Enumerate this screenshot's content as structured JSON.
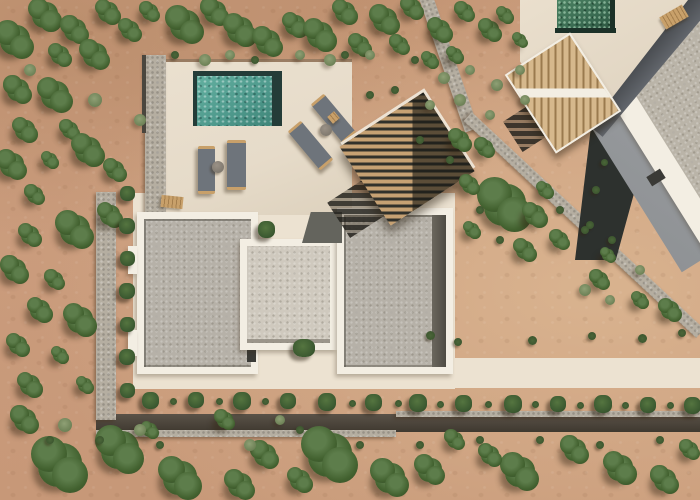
{
  "scene": {
    "description": "Aerial drone photograph of a modern villa: cream pool terrace with teal plunge pool and four grey sun loungers, three gravel flat roofs framed in white, wooden slatted pergola, stone perimeter walls, rows of landscaped plants, sandy garden with scattered green trees, and a neighboring villa with green plunge pool at upper right.",
    "colors": {
      "sand-base": "#cd9f80",
      "sand-dark": "#bb8e6d",
      "sand-light": "#d9b38f",
      "terrace": "#e6dbc9",
      "walkway": "#ece2d1",
      "white-trim": "#f3eee3",
      "gravel-warm": "#b6b1a8",
      "gravel-light": "#cfc9be",
      "gravel-neighbor": "#bab4a8",
      "dark-paving": "#64645d",
      "pool-teal": "#4f9a8d",
      "pool-rim": "#243c38",
      "neighbor-pool-green": "#3a6b52",
      "stone": "#b5aea1",
      "wall-shadow": "#3f3930",
      "tree-green": "#42612f",
      "shrub-sage": "#6d8156",
      "cushion-gray": "#6e747b",
      "wood-tan": "#c8a06a",
      "pergola-wood": "#c6a173",
      "pergola-gap": "#31312b",
      "neighbor-wall-gray": "#9b9ea1",
      "shadow-gap": "#2d312e"
    },
    "objects": [
      {
        "name": "boundary-wall-upper",
        "cls": "stone-wall",
        "x": 442,
        "y": -6,
        "w": 14,
        "h": 140,
        "rot": -19
      },
      {
        "name": "boundary-wall-lower",
        "cls": "stone-wall",
        "x": 425,
        "y": 219,
        "w": 318,
        "h": 12,
        "rot": 43
      },
      {
        "name": "perimeter-wall-bottom-dark",
        "cls": "wall-dark-band",
        "x": 96,
        "y": 414,
        "w": 604,
        "h": 18
      },
      {
        "name": "perimeter-wall-bottom-light",
        "cls": "stone-wall",
        "x": 96,
        "y": 430,
        "w": 300,
        "h": 7
      },
      {
        "name": "perimeter-wall-bottom-light-right",
        "cls": "stone-wall",
        "x": 396,
        "y": 411,
        "w": 304,
        "h": 6
      },
      {
        "name": "perimeter-wall-left",
        "cls": "stone-wall",
        "x": 96,
        "y": 192,
        "w": 20,
        "h": 228
      },
      {
        "name": "neighbor-shadow-gap",
        "cls": "gap-dark",
        "x": 558,
        "y": 118,
        "w": 85,
        "h": 142
      },
      {
        "name": "neighbor-wall-face",
        "cls": "nwall",
        "x": 594,
        "y": -34,
        "w": 214,
        "h": 270,
        "rot": -32
      },
      {
        "name": "neighbor-roof-border",
        "cls": "white-rect",
        "x": 622,
        "y": -36,
        "w": 184,
        "h": 256,
        "rot": -32
      },
      {
        "name": "neighbor-roof-gravel",
        "cls": "gravel-n",
        "x": 644,
        "y": -34,
        "w": 160,
        "h": 240,
        "rot": -32
      },
      {
        "name": "neighbor-roof-vent",
        "cls": "vent",
        "x": 648,
        "y": 172,
        "w": 16,
        "h": 11,
        "rot": -32
      },
      {
        "name": "neighbor-shadow-wall",
        "cls": "ndark",
        "x": 563,
        "y": 52,
        "w": 170,
        "h": 24,
        "rot": 130
      },
      {
        "name": "neighbor-pool-deck",
        "cls": "ndeck",
        "x": 520,
        "y": 0,
        "w": 168,
        "h": 118
      },
      {
        "name": "neighbor-pool",
        "cls": "npool",
        "x": 557,
        "y": 0,
        "w": 55,
        "h": 30
      },
      {
        "name": "neighbor-pool-rim-bottom",
        "cls": "npool-rim",
        "x": 555,
        "y": 28,
        "w": 61,
        "h": 5
      },
      {
        "name": "neighbor-pool-rim-right",
        "cls": "npool-rim",
        "x": 610,
        "y": 0,
        "w": 5,
        "h": 32
      },
      {
        "name": "neighbor-deck-bench",
        "cls": "wood-bench",
        "x": 661,
        "y": 10,
        "w": 26,
        "h": 14,
        "rot": -30
      },
      {
        "name": "villa-walkway",
        "cls": "walkway",
        "x": 133,
        "y": 193,
        "w": 322,
        "h": 196
      },
      {
        "name": "garden-path",
        "cls": "walkway",
        "x": 345,
        "y": 358,
        "w": 355,
        "h": 30
      },
      {
        "name": "pool-terrace",
        "cls": "patio",
        "x": 165,
        "y": 62,
        "w": 187,
        "h": 153
      },
      {
        "name": "terrace-top-edge",
        "cls": "edge-line",
        "x": 166,
        "y": 59,
        "w": 186,
        "h": 3
      },
      {
        "name": "perimeter-wall-terrace",
        "cls": "stone-wall",
        "x": 145,
        "y": 55,
        "w": 21,
        "h": 160
      },
      {
        "name": "terrace-wall-shadow",
        "cls": "dark-line",
        "x": 142,
        "y": 55,
        "w": 4,
        "h": 78
      },
      {
        "name": "roof-left-frame",
        "cls": "white-rect",
        "x": 137,
        "y": 212,
        "w": 121,
        "h": 162
      },
      {
        "name": "roof-left-gravel",
        "cls": "gravel-a",
        "x": 144,
        "y": 219,
        "w": 107,
        "h": 148
      },
      {
        "name": "roof-left-door",
        "cls": "vent",
        "x": 247,
        "y": 338,
        "w": 9,
        "h": 24
      },
      {
        "name": "roof-left-tab-upper",
        "cls": "white-rect",
        "x": 128,
        "y": 246,
        "w": 9,
        "h": 28
      },
      {
        "name": "roof-left-tab-lower",
        "cls": "white-rect",
        "x": 128,
        "y": 330,
        "w": 9,
        "h": 26
      },
      {
        "name": "roof-middle-frame",
        "cls": "white-rect",
        "x": 240,
        "y": 239,
        "w": 97,
        "h": 111
      },
      {
        "name": "roof-middle-gravel",
        "cls": "gravel-b",
        "x": 247,
        "y": 246,
        "w": 83,
        "h": 97
      },
      {
        "name": "roof-right-frame",
        "cls": "white-rect",
        "x": 337,
        "y": 208,
        "w": 116,
        "h": 166
      },
      {
        "name": "roof-right-gravel",
        "cls": "gravel-a",
        "x": 344,
        "y": 215,
        "w": 102,
        "h": 152
      },
      {
        "name": "roof-right-dark-strip",
        "cls": "dark-strip",
        "x": 432,
        "y": 215,
        "w": 14,
        "h": 152
      },
      {
        "name": "dark-paving-patch",
        "cls": "dark-pav",
        "x": 302,
        "y": 212,
        "w": 40,
        "h": 31
      },
      {
        "name": "plunge-pool",
        "cls": "pool",
        "x": 196,
        "y": 74,
        "w": 84,
        "h": 52
      },
      {
        "name": "pool-rim-top",
        "cls": "pool-rim",
        "x": 196,
        "y": 71,
        "w": 84,
        "h": 5
      },
      {
        "name": "pool-rim-right",
        "cls": "pool-rim",
        "x": 272,
        "y": 71,
        "w": 10,
        "h": 55
      },
      {
        "name": "pool-rim-left",
        "cls": "pool-rim",
        "x": 193,
        "y": 71,
        "w": 4,
        "h": 55
      },
      {
        "name": "sun-lounger-1",
        "cls": "lounger",
        "x": 198,
        "y": 146,
        "w": 17,
        "h": 42
      },
      {
        "name": "sun-lounger-2",
        "cls": "lounger",
        "x": 227,
        "y": 140,
        "w": 19,
        "h": 44
      },
      {
        "name": "side-table-1",
        "cls": "round-table",
        "x": 212,
        "y": 161,
        "w": 12,
        "h": 12
      },
      {
        "name": "sun-lounger-3",
        "cls": "lounger",
        "x": 325,
        "y": 93,
        "w": 17,
        "h": 45,
        "rot": -40
      },
      {
        "name": "sun-lounger-4",
        "cls": "lounger",
        "x": 302,
        "y": 120,
        "w": 17,
        "h": 45,
        "rot": -40
      },
      {
        "name": "side-table-2",
        "cls": "round-table",
        "x": 320,
        "y": 124,
        "w": 12,
        "h": 12
      },
      {
        "name": "wood-stool",
        "cls": "wood-bench",
        "x": 329,
        "y": 113,
        "w": 9,
        "h": 9,
        "rot": -40
      },
      {
        "name": "terrace-bench",
        "cls": "wood-bench",
        "x": 161,
        "y": 196,
        "w": 22,
        "h": 12,
        "rot": 6
      },
      {
        "name": "terrace-planter",
        "cls": "plant",
        "x": 258,
        "y": 221,
        "w": 17,
        "h": 17
      },
      {
        "name": "courtyard-plant",
        "cls": "plant",
        "x": 293,
        "y": 339,
        "w": 22,
        "h": 18
      },
      {
        "name": "pergola-shadow",
        "cls": "pshadow",
        "x": 330,
        "y": 170,
        "w": 108,
        "h": 42,
        "rot": -33
      },
      {
        "name": "main-pergola",
        "cls": "pergola",
        "x": 357,
        "y": 112,
        "w": 100,
        "h": 94,
        "rot": -33
      },
      {
        "name": "neighbor-pergola-shadow",
        "cls": "pshadow",
        "x": 506,
        "y": 96,
        "w": 84,
        "h": 36,
        "rot": -33
      },
      {
        "name": "neighbor-pergola",
        "cls": "npergola",
        "x": 524,
        "y": 46,
        "w": 74,
        "h": 90,
        "rot": -33
      }
    ],
    "vegetation": {
      "trees": [
        [
          15,
          40,
          30
        ],
        [
          45,
          15,
          26
        ],
        [
          75,
          30,
          22
        ],
        [
          108,
          12,
          20
        ],
        [
          60,
          55,
          18
        ],
        [
          95,
          55,
          24
        ],
        [
          130,
          30,
          18
        ],
        [
          150,
          12,
          16
        ],
        [
          185,
          25,
          30
        ],
        [
          215,
          12,
          22
        ],
        [
          240,
          30,
          26
        ],
        [
          268,
          42,
          24
        ],
        [
          295,
          25,
          20
        ],
        [
          320,
          35,
          26
        ],
        [
          345,
          12,
          20
        ],
        [
          360,
          45,
          18
        ],
        [
          385,
          20,
          24
        ],
        [
          400,
          45,
          16
        ],
        [
          412,
          8,
          18
        ],
        [
          440,
          30,
          20
        ],
        [
          465,
          12,
          16
        ],
        [
          490,
          30,
          18
        ],
        [
          455,
          55,
          14
        ],
        [
          430,
          60,
          14
        ],
        [
          505,
          15,
          14
        ],
        [
          520,
          40,
          12
        ],
        [
          18,
          90,
          22
        ],
        [
          55,
          95,
          28
        ],
        [
          25,
          130,
          20
        ],
        [
          70,
          130,
          16
        ],
        [
          12,
          165,
          24
        ],
        [
          50,
          160,
          14
        ],
        [
          88,
          150,
          26
        ],
        [
          115,
          170,
          18
        ],
        [
          35,
          195,
          16
        ],
        [
          75,
          230,
          30
        ],
        [
          30,
          235,
          18
        ],
        [
          110,
          215,
          20
        ],
        [
          15,
          270,
          22
        ],
        [
          55,
          280,
          16
        ],
        [
          40,
          310,
          20
        ],
        [
          80,
          320,
          26
        ],
        [
          18,
          345,
          18
        ],
        [
          60,
          355,
          14
        ],
        [
          30,
          385,
          20
        ],
        [
          85,
          385,
          14
        ],
        [
          460,
          140,
          18
        ],
        [
          485,
          148,
          16
        ],
        [
          505,
          205,
          42
        ],
        [
          470,
          185,
          16
        ],
        [
          535,
          215,
          20
        ],
        [
          472,
          230,
          14
        ],
        [
          525,
          250,
          18
        ],
        [
          560,
          240,
          16
        ],
        [
          545,
          190,
          14
        ],
        [
          600,
          280,
          16
        ],
        [
          640,
          300,
          14
        ],
        [
          670,
          310,
          18
        ],
        [
          608,
          255,
          12
        ],
        [
          25,
          420,
          22
        ],
        [
          60,
          465,
          44
        ],
        [
          120,
          450,
          38
        ],
        [
          180,
          478,
          34
        ],
        [
          225,
          420,
          16
        ],
        [
          265,
          455,
          22
        ],
        [
          330,
          455,
          44
        ],
        [
          390,
          478,
          30
        ],
        [
          430,
          470,
          24
        ],
        [
          455,
          440,
          16
        ],
        [
          520,
          472,
          30
        ],
        [
          575,
          450,
          22
        ],
        [
          620,
          468,
          26
        ],
        [
          665,
          480,
          22
        ],
        [
          690,
          450,
          16
        ],
        [
          300,
          480,
          20
        ],
        [
          150,
          430,
          14
        ],
        [
          240,
          485,
          24
        ],
        [
          490,
          455,
          18
        ]
      ],
      "shrubs": [
        [
          95,
          100,
          14
        ],
        [
          140,
          120,
          12
        ],
        [
          30,
          70,
          12
        ],
        [
          65,
          425,
          14
        ],
        [
          140,
          430,
          12
        ],
        [
          250,
          445,
          12
        ],
        [
          280,
          420,
          10
        ],
        [
          205,
          60,
          12
        ],
        [
          230,
          55,
          10
        ],
        [
          330,
          60,
          12
        ],
        [
          370,
          55,
          10
        ],
        [
          300,
          55,
          10
        ],
        [
          444,
          78,
          12
        ],
        [
          470,
          70,
          10
        ],
        [
          497,
          85,
          12
        ],
        [
          520,
          70,
          10
        ],
        [
          460,
          100,
          12
        ],
        [
          490,
          115,
          10
        ],
        [
          430,
          105,
          10
        ],
        [
          525,
          100,
          10
        ],
        [
          585,
          290,
          12
        ],
        [
          640,
          270,
          10
        ],
        [
          610,
          300,
          10
        ]
      ],
      "tufts": [
        [
          175,
          55,
          8
        ],
        [
          255,
          60,
          8
        ],
        [
          345,
          55,
          8
        ],
        [
          415,
          60,
          8
        ],
        [
          450,
          160,
          8
        ],
        [
          480,
          210,
          8
        ],
        [
          500,
          240,
          8
        ],
        [
          430,
          335,
          9
        ],
        [
          458,
          342,
          8
        ],
        [
          532,
          340,
          9
        ],
        [
          592,
          336,
          8
        ],
        [
          642,
          338,
          9
        ],
        [
          682,
          333,
          8
        ],
        [
          560,
          210,
          8
        ],
        [
          590,
          225,
          8
        ],
        [
          612,
          240,
          8
        ],
        [
          370,
          95,
          8
        ],
        [
          395,
          90,
          8
        ],
        [
          420,
          140,
          8
        ],
        [
          585,
          230,
          8
        ],
        [
          596,
          190,
          8
        ],
        [
          604,
          162,
          7
        ],
        [
          50,
          440,
          8
        ],
        [
          100,
          440,
          8
        ],
        [
          160,
          445,
          8
        ],
        [
          300,
          430,
          8
        ],
        [
          360,
          445,
          8
        ],
        [
          420,
          445,
          8
        ],
        [
          480,
          440,
          8
        ],
        [
          540,
          440,
          8
        ],
        [
          600,
          445,
          8
        ],
        [
          660,
          440,
          8
        ],
        [
          173,
          401,
          7
        ],
        [
          219,
          401,
          7
        ],
        [
          265,
          401,
          7
        ],
        [
          352,
          403,
          7
        ],
        [
          398,
          403,
          7
        ],
        [
          440,
          404,
          7
        ],
        [
          488,
          404,
          7
        ],
        [
          535,
          404,
          7
        ],
        [
          580,
          405,
          7
        ],
        [
          625,
          405,
          7
        ],
        [
          670,
          405,
          7
        ]
      ],
      "row_plants": [
        [
          127,
          193,
          15
        ],
        [
          127,
          226,
          16
        ],
        [
          127,
          258,
          15
        ],
        [
          127,
          291,
          16
        ],
        [
          127,
          324,
          15
        ],
        [
          127,
          357,
          16
        ],
        [
          127,
          390,
          15
        ],
        [
          150,
          400,
          17
        ],
        [
          196,
          400,
          16
        ],
        [
          242,
          401,
          18
        ],
        [
          288,
          401,
          16
        ],
        [
          327,
          402,
          18
        ],
        [
          373,
          402,
          17
        ],
        [
          418,
          403,
          18
        ],
        [
          463,
          403,
          17
        ],
        [
          513,
          404,
          18
        ],
        [
          558,
          404,
          16
        ],
        [
          603,
          404,
          18
        ],
        [
          648,
          405,
          16
        ],
        [
          692,
          405,
          17
        ]
      ]
    }
  }
}
